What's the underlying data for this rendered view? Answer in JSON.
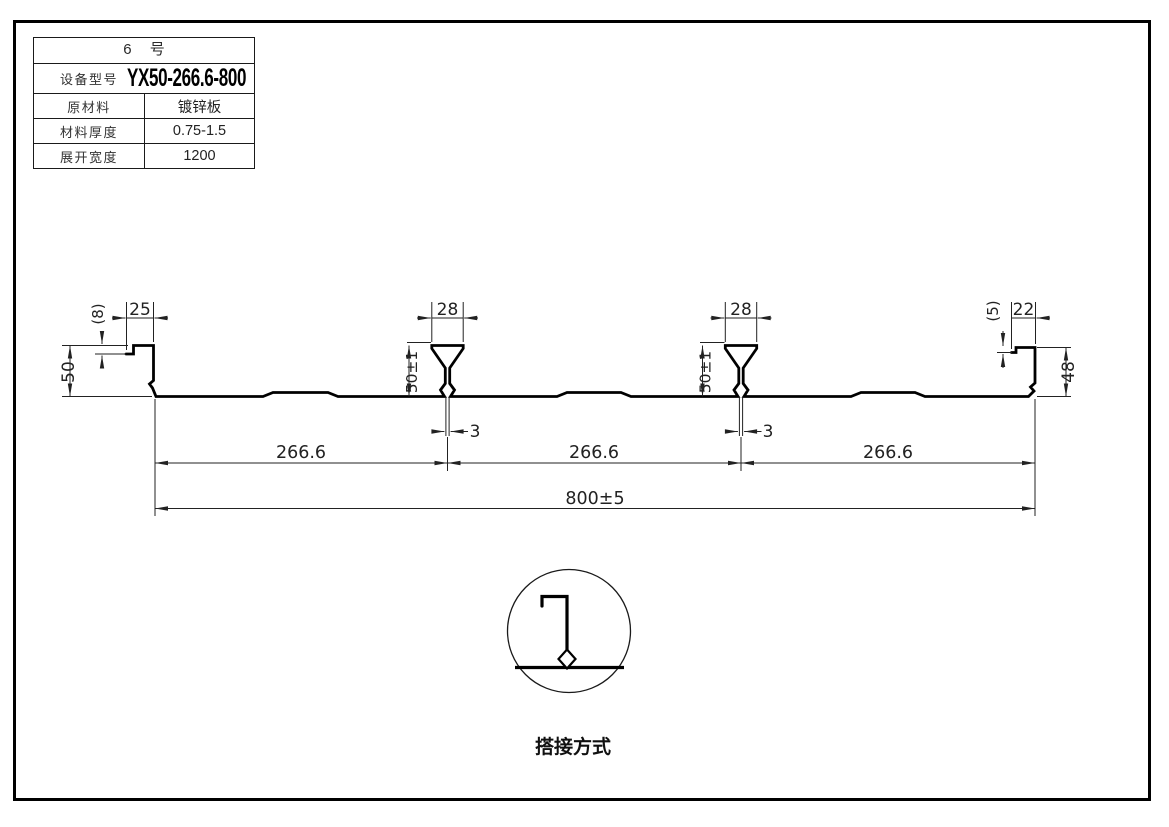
{
  "window": {
    "background": "#ffffff",
    "frame_border_color": "#000000",
    "line_color": "#000000"
  },
  "spec_table": {
    "title": "6 号",
    "rows": [
      {
        "label": "设备型号",
        "value": "YX50-266.6-800"
      },
      {
        "label": "原材料",
        "value": "镀锌板"
      },
      {
        "label": "材料厚度",
        "value": "0.75-1.5"
      },
      {
        "label": "展开宽度",
        "value": "1200"
      }
    ]
  },
  "profile_drawing": {
    "dimensions": {
      "left_height": "50",
      "left_step": "(8)",
      "left_lip": "25",
      "rib1_width": "28",
      "rib1_height": "50±1",
      "rib1_gap": "3",
      "rib2_width": "28",
      "rib2_height": "50±1",
      "rib2_gap": "3",
      "right_step": "(5)",
      "right_lip": "22",
      "right_height": "48",
      "span1": "266.6",
      "span2": "266.6",
      "span3": "266.6",
      "overall_width": "800±5"
    },
    "lap_detail": {
      "caption": "搭接方式"
    }
  }
}
